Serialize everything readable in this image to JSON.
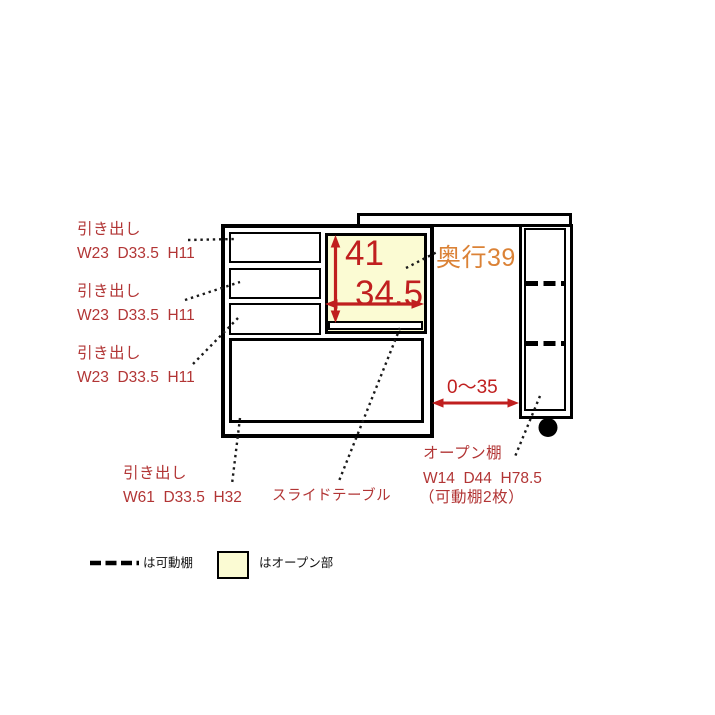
{
  "diagram": {
    "drawer_labels": [
      {
        "title": "引き出し",
        "dims": "W23  D33.5  H11"
      },
      {
        "title": "引き出し",
        "dims": "W23  D33.5  H11"
      },
      {
        "title": "引き出し",
        "dims": "W23  D33.5  H11"
      }
    ],
    "bottom_drawer_label": {
      "title": "引き出し",
      "dims": "W61  D33.5  H32"
    },
    "slide_table_label": "スライドテーブル",
    "open_shelf_label": {
      "title": "オープン棚",
      "dims": "W14  D44  H78.5",
      "note": "（可動棚2枚）"
    },
    "open_section_height": "41",
    "open_section_width": "34.5",
    "depth_label": "奥行39",
    "gap_label": "0～35"
  },
  "legend": {
    "movable_shelf": "は可動棚",
    "open_section": "はオープン部"
  },
  "colors": {
    "label_red": "#B23535",
    "dimension_red": "#C01F1F",
    "depth_orange": "#DB8236",
    "open_section_fill": "#FBFBD3",
    "line_black": "#000000"
  }
}
